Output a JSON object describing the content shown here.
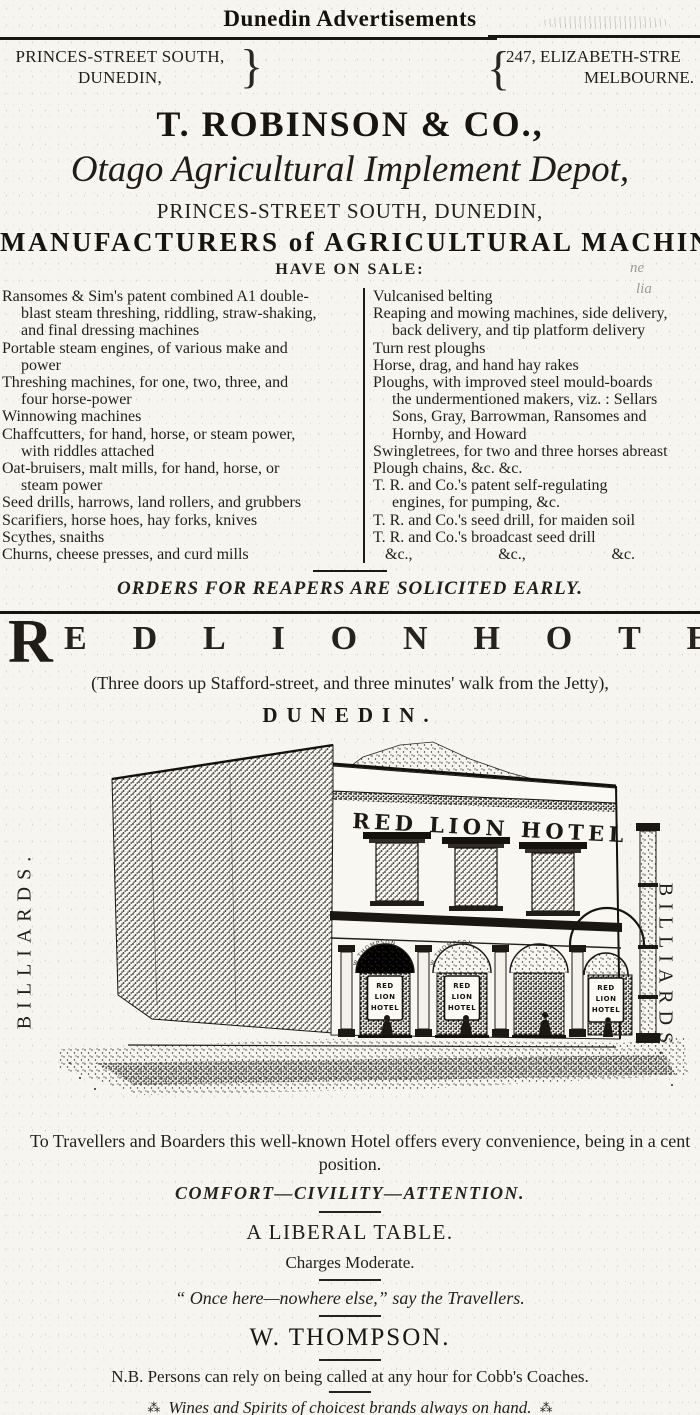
{
  "colors": {
    "ink": "#221f1a",
    "paper": "#f6f5ef"
  },
  "page": {
    "header": "Dunedin Advertisements"
  },
  "robinson_ad": {
    "address_left_line1": "PRINCES-STREET SOUTH,",
    "address_left_line2": "DUNEDIN,",
    "brace_left": "}",
    "brace_right": "{",
    "address_right_line1": "247, ELIZABETH-STRE",
    "address_right_line2": "MELBOURNE.",
    "company": "T. ROBINSON & CO.,",
    "depot": "Otago Agricultural Implement Depot,",
    "address_center": "PRINCES-STREET SOUTH, DUNEDIN,",
    "manufacturers": "MANUFACTURERS of AGRICULTURAL MACHINERY",
    "have_on_sale": "HAVE ON SALE:",
    "left_column_lines": [
      {
        "t": "Ransomes & Sim's patent combined A1 double-",
        "i": 0
      },
      {
        "t": "blast steam threshing, riddling, straw-shaking,",
        "i": 1
      },
      {
        "t": "and final dressing machines",
        "i": 1
      },
      {
        "t": "Portable steam engines, of various make and",
        "i": 0
      },
      {
        "t": "power",
        "i": 1
      },
      {
        "t": "Threshing machines, for one, two, three, and",
        "i": 0
      },
      {
        "t": "four horse-power",
        "i": 1
      },
      {
        "t": "Winnowing machines",
        "i": 0
      },
      {
        "t": "Chaffcutters, for hand, horse, or steam power,",
        "i": 0
      },
      {
        "t": "with riddles attached",
        "i": 1
      },
      {
        "t": "Oat-bruisers, malt mills, for hand, horse, or",
        "i": 0
      },
      {
        "t": "steam power",
        "i": 1
      },
      {
        "t": "Seed drills, harrows, land rollers, and grubbers",
        "i": 0
      },
      {
        "t": "Scarifiers, horse hoes, hay forks, knives",
        "i": 0
      },
      {
        "t": "Scythes, snaiths",
        "i": 0
      },
      {
        "t": "Churns, cheese presses, and curd mills",
        "i": 0
      }
    ],
    "right_column_lines": [
      {
        "t": "Vulcanised belting",
        "i": 0
      },
      {
        "t": "Reaping and mowing machines, side delivery,",
        "i": 0
      },
      {
        "t": "back delivery, and tip platform delivery",
        "i": 1
      },
      {
        "t": "Turn rest ploughs",
        "i": 0
      },
      {
        "t": "Horse, drag, and hand hay rakes",
        "i": 0
      },
      {
        "t": "Ploughs, with improved steel mould-boards",
        "i": 0
      },
      {
        "t": "the undermentioned makers, viz. : Sellars",
        "i": 1
      },
      {
        "t": "Sons, Gray, Barrowman, Ransomes and",
        "i": 1
      },
      {
        "t": "Hornby, and Howard",
        "i": 1
      },
      {
        "t": "Swingletrees, for two and three horses abreast",
        "i": 0
      },
      {
        "t": "Plough chains, &c. &c.",
        "i": 0
      },
      {
        "t": "T. R. and Co.'s patent self-regulating",
        "i": 0
      },
      {
        "t": "engines, for pumping, &c.",
        "i": 1
      },
      {
        "t": "T. R. and Co.'s seed drill, for maiden soil",
        "i": 0
      },
      {
        "t": "T. R. and Co.'s broadcast seed drill",
        "i": 0
      }
    ],
    "etc_items": [
      "&c.,",
      "&c.,",
      "&c."
    ],
    "noise_mark_1": "ne",
    "noise_mark_2": "lia",
    "orders": "ORDERS FOR REAPERS ARE SOLICITED EARLY."
  },
  "red_lion_ad": {
    "initial": "R",
    "rest_letters": [
      "E",
      "D",
      "L",
      "I",
      "O",
      "N",
      "H",
      "O",
      "T",
      "E",
      "L"
    ],
    "location_line": "(Three doors up Stafford-street, and three minutes' walk from the Jetty),",
    "city": "DUNEDIN.",
    "billiards_left": "BILLIARDS.",
    "billiards_right": "BILLIARDS.",
    "engraving": {
      "facade_sign": "RED LION HOTEL",
      "door_sign_lines": [
        "RED",
        "LION",
        "HOTEL"
      ],
      "fanlight_text": "W THOMPSON"
    },
    "caption_line1": "To Travellers and Boarders this well-known Hotel offers every convenience, being in a cent",
    "caption_line2": "position.",
    "motto": "COMFORT—CIVILITY—ATTENTION.",
    "liberal_table": "A LIBERAL TABLE.",
    "charges": "Charges Moderate.",
    "quote": "“ Once here—nowhere else,” say the Travellers.",
    "proprietor": "W. THOMPSON.",
    "nb_line": "N.B.  Persons can rely on being called at any hour for Cobb's Coaches.",
    "wines_line": "Wines and Spirits of choicest brands always on hand.",
    "asterism": "⁂"
  }
}
